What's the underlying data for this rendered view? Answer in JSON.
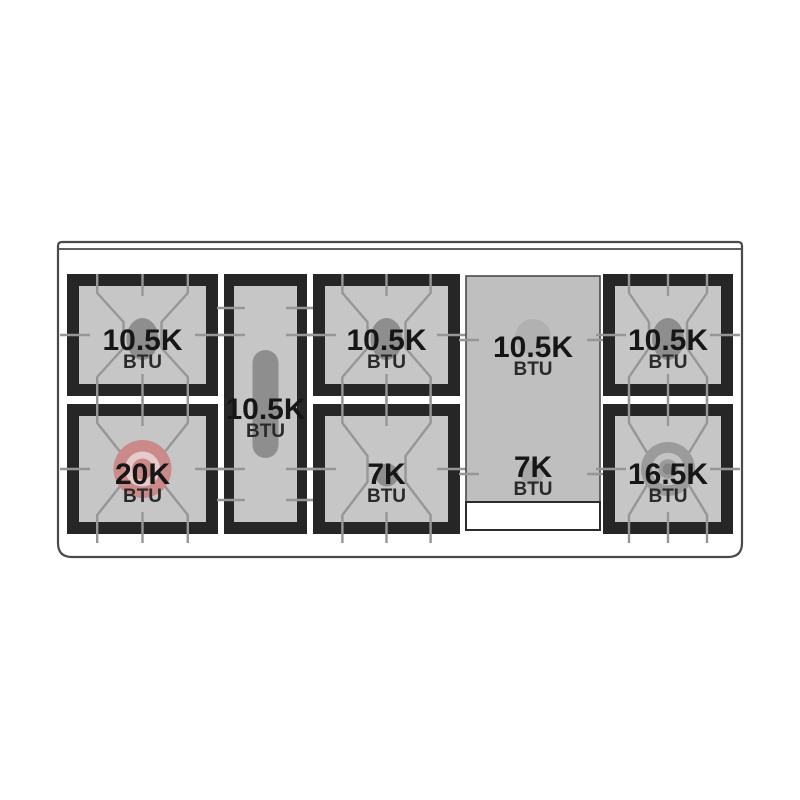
{
  "diagram": {
    "unit_label": "BTU",
    "burners": [
      {
        "name": "left-rear",
        "power": "10.5K",
        "unit": "BTU"
      },
      {
        "name": "left-front",
        "power": "20K",
        "unit": "BTU"
      },
      {
        "name": "center-oval",
        "power": "10.5K",
        "unit": "BTU"
      },
      {
        "name": "middle-rear",
        "power": "10.5K",
        "unit": "BTU"
      },
      {
        "name": "middle-front",
        "power": "7K",
        "unit": "BTU"
      },
      {
        "name": "griddle-rear",
        "power": "10.5K",
        "unit": "BTU"
      },
      {
        "name": "griddle-front",
        "power": "7K",
        "unit": "BTU"
      },
      {
        "name": "right-rear",
        "power": "10.5K",
        "unit": "BTU"
      },
      {
        "name": "right-front",
        "power": "16.5K",
        "unit": "BTU"
      }
    ],
    "colors": {
      "frame": "#262626",
      "grate_surface": "#c6c6c6",
      "grate_line": "#969696",
      "burner_gray": "#8e8e8e",
      "griddle_surface": "#bfbfbf",
      "high_power_accent": "#cb8a8a",
      "high_power_ring": "#e6cbcb",
      "dual_ring_gray": "#9b9b9b",
      "panel_outline": "#4a4a4a"
    }
  }
}
